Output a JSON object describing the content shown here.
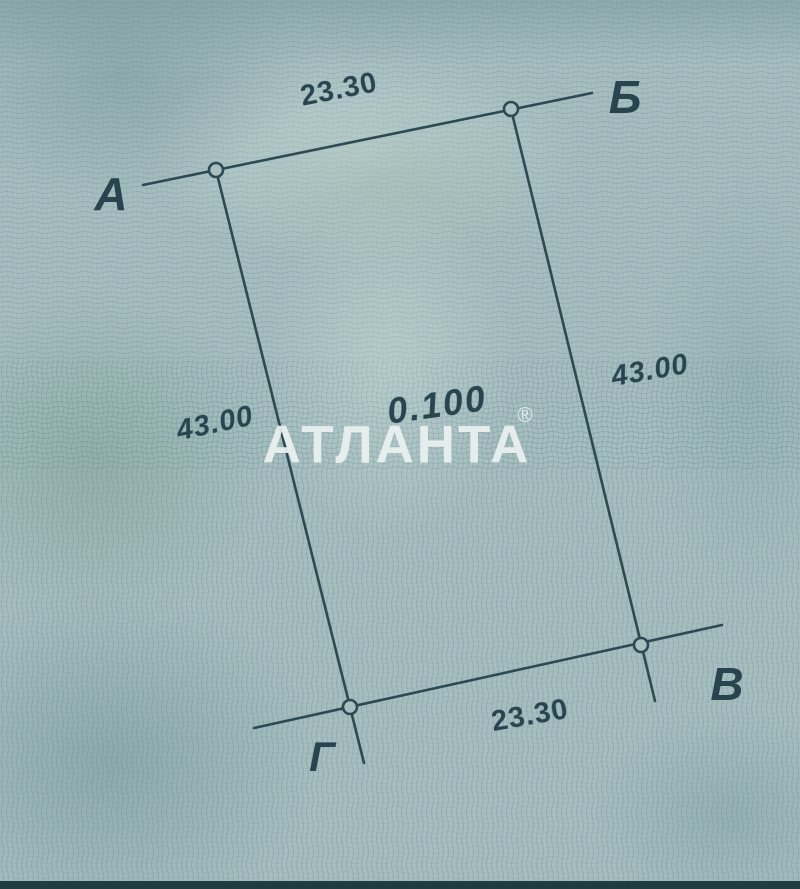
{
  "document": {
    "kind": "land-plot-survey-sketch",
    "colors": {
      "paper": "#a6bec0",
      "ink": "#28454f",
      "watermark": "#ecf2f1",
      "scan_edge": "#203d41"
    }
  },
  "watermark": {
    "text": "АТЛАНТА",
    "reg": "®"
  },
  "plot": {
    "area": "0.100",
    "corners": {
      "a": "А",
      "b": "Б",
      "v": "В",
      "g": "Г"
    },
    "dimensions": {
      "top": "23.30",
      "right": "43.00",
      "bottom": "23.30",
      "left": "43.00"
    }
  }
}
